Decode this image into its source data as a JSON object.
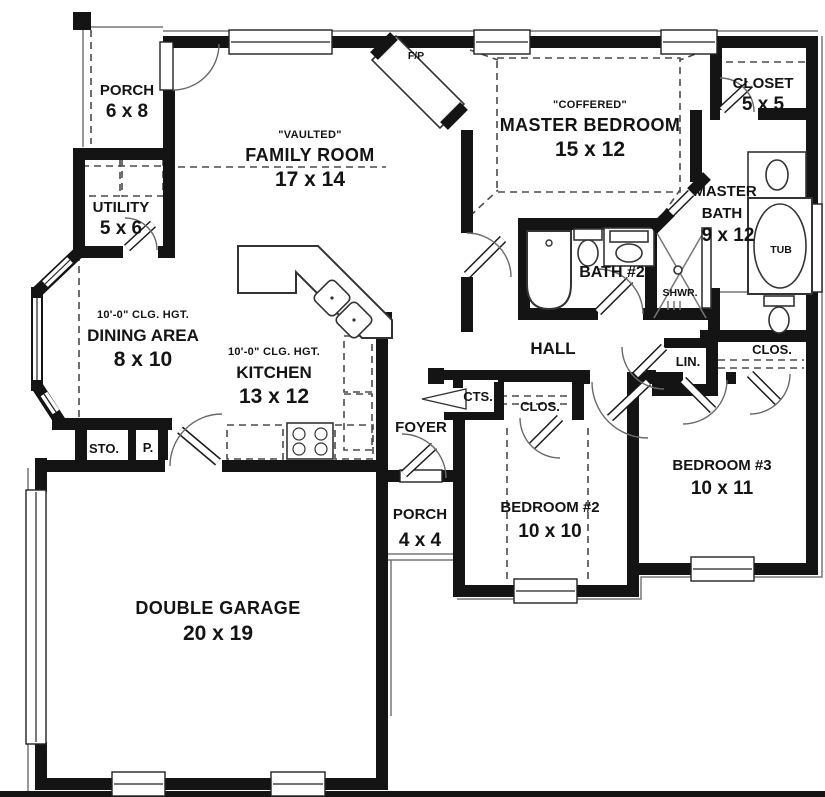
{
  "colors": {
    "background": "#ffffff",
    "wall": "#141414",
    "thin_line": "#777777",
    "dashed_line": "#4a4a4a",
    "text": "#111111"
  },
  "rooms": {
    "porch1": {
      "name": "PORCH",
      "dims": "6 x 8"
    },
    "utility": {
      "name": "UTILITY",
      "dims": "5 x 6"
    },
    "family": {
      "note": "\"VAULTED\"",
      "name": "FAMILY ROOM",
      "dims": "17 x 14"
    },
    "fireplace": {
      "name": "F/P"
    },
    "master": {
      "note": "\"COFFERED\"",
      "name": "MASTER BEDROOM",
      "dims": "15 x 12"
    },
    "closet": {
      "name": "CLOSET",
      "dims": "5 x 5"
    },
    "master_bath": {
      "name_line1": "MASTER",
      "name_line2": "BATH",
      "dims": "9 x 12"
    },
    "tub": {
      "name": "TUB"
    },
    "bath2": {
      "name": "BATH #2"
    },
    "shower": {
      "name": "SHWR."
    },
    "hall": {
      "name": "HALL"
    },
    "linen": {
      "name": "LIN."
    },
    "closet_right": {
      "name": "CLOS."
    },
    "dining": {
      "note": "10'-0\" CLG. HGT.",
      "name": "DINING AREA",
      "dims": "8 x 10"
    },
    "kitchen": {
      "note": "10'-0\" CLG. HGT.",
      "name": "KITCHEN",
      "dims": "13 x 12"
    },
    "storage": {
      "name": "STO."
    },
    "pantry": {
      "name": "P."
    },
    "foyer": {
      "name": "FOYER"
    },
    "coat_closet": {
      "name": "CTS."
    },
    "closet_mid": {
      "name": "CLOS."
    },
    "porch2": {
      "name": "PORCH",
      "dims": "4 x 4"
    },
    "bedroom2": {
      "name": "BEDROOM #2",
      "dims": "10 x 10"
    },
    "bedroom3": {
      "name": "BEDROOM #3",
      "dims": "10 x 11"
    },
    "garage": {
      "name": "DOUBLE GARAGE",
      "dims": "20 x 19"
    }
  }
}
